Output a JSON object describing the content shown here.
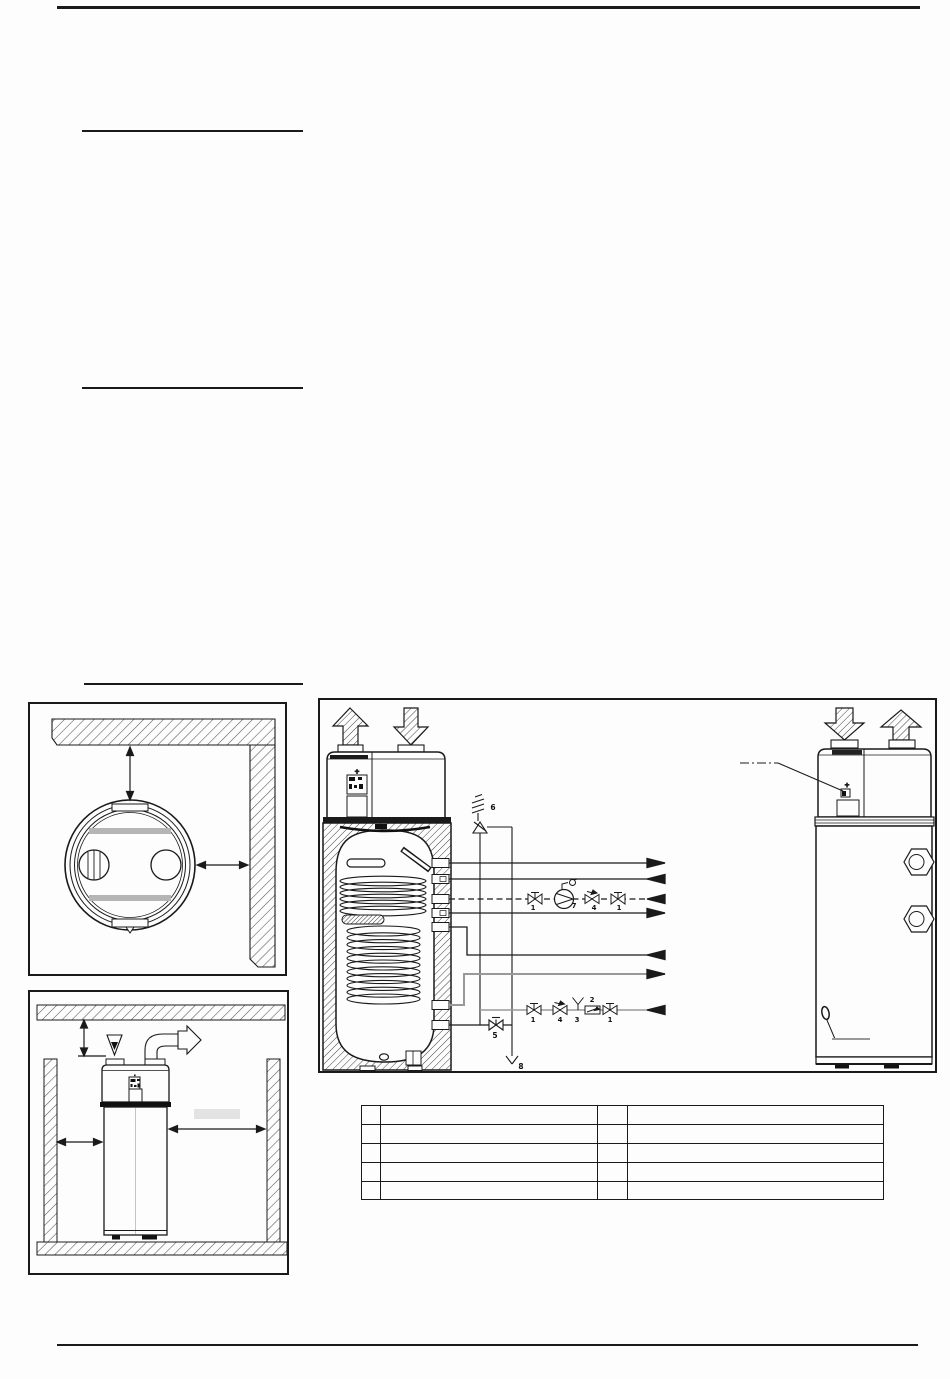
{
  "colors": {
    "line": "#1a1a1a",
    "gray_pipe": "#999999",
    "light_bar": "#b5b5b5"
  },
  "schematic": {
    "safety_group_label": "6",
    "discharge_funnel_label": "8",
    "drain_valve_label": "5",
    "recirc_labels": [
      "1",
      "7",
      "4",
      "1"
    ],
    "inlet_labels": [
      "1",
      "4",
      "3",
      "2",
      "1"
    ],
    "left_panel_plus": "+",
    "right_panel_plus": "+"
  },
  "legend_table": {
    "rows": [
      [
        "",
        "",
        "",
        ""
      ],
      [
        "",
        "",
        "",
        ""
      ],
      [
        "",
        "",
        "",
        ""
      ],
      [
        "",
        "",
        "",
        ""
      ],
      [
        "",
        "",
        "",
        ""
      ]
    ]
  }
}
